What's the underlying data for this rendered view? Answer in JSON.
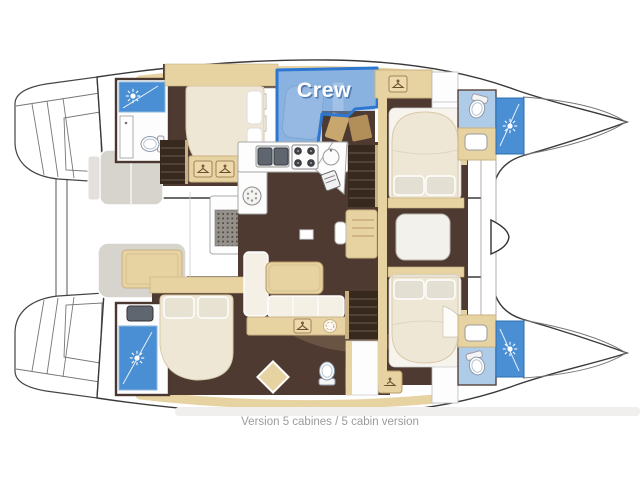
{
  "window": {
    "width": 640,
    "height": 480,
    "background": "#ffffff"
  },
  "plan": {
    "crew_label": "Crew",
    "caption": "Version 5 cabines / 5 cabin version",
    "colors": {
      "crew_border": "#2e77d0",
      "crew_overlay": "#5b93d6",
      "bathroom_blue": "#aecbe8",
      "shower_blue": "#4a8fd3",
      "floor_brown": "#4e3a31",
      "stairs_brown": "#38291f",
      "wood_beige": "#e7d2a2",
      "bed_cream": "#efe7d6",
      "cockpit_gray": "#d7d3cd",
      "hull_outline": "#3a3a3a",
      "caption_gray": "#9b9b9b"
    },
    "icons": [
      "shower-head-icon",
      "coat-hanger-icon",
      "toilet-icon",
      "double-sink-icon",
      "stove-icon",
      "round-sink-icon",
      "fridge-icon",
      "floor-hatch-icon",
      "vent-icon",
      "washbasin-icon",
      "wheel-icon",
      "mast-icon"
    ]
  }
}
